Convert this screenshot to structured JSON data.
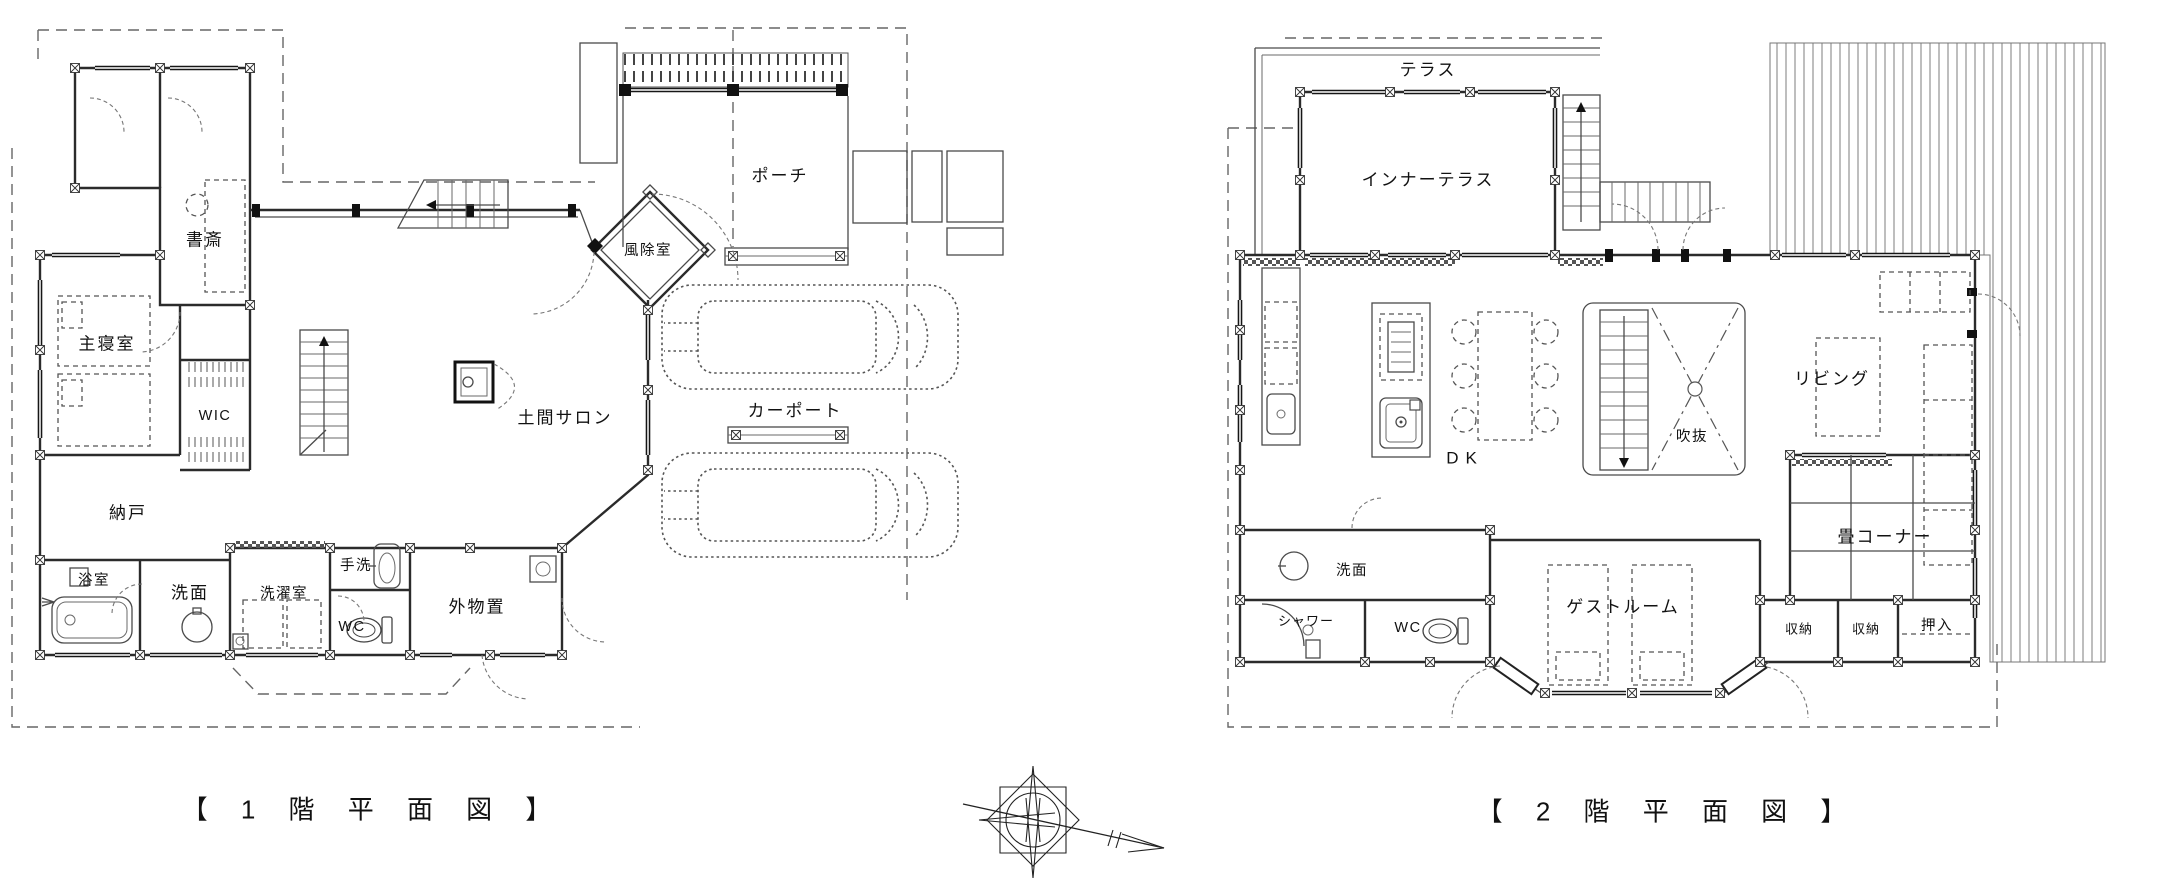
{
  "colors": {
    "ink": "#2b2b2b",
    "background": "#ffffff"
  },
  "icons": {
    "compass": "compass-rose-north-arrow",
    "cars": "car-outline",
    "stairs": "stair-flight"
  },
  "floor1": {
    "caption": "【 1 階 平 面 図 】",
    "rooms": {
      "study": "書斎",
      "master_bedroom": "主寝室",
      "wic": "WIC",
      "storeroom": "納戸",
      "bathroom": "浴室",
      "washroom": "洗面",
      "laundry": "洗濯室",
      "hand_basin": "手洗",
      "wc": "WC",
      "outdoor_storage": "外物置",
      "doma_salon": "土間サロン",
      "windbreak_room": "風除室",
      "porch": "ポーチ",
      "carport": "カーポート"
    }
  },
  "floor2": {
    "caption": "【 2 階 平 面 図 】",
    "rooms": {
      "terrace": "テラス",
      "inner_terrace": "インナーテラス",
      "dk": "DK",
      "void_atrium": "吹抜",
      "living": "リビング",
      "tatami_corner": "畳コーナー",
      "washroom": "洗面",
      "shower": "シャワー",
      "wc": "WC",
      "guest_room": "ゲストルーム",
      "closet1": "収納",
      "closet2": "収納",
      "futon_closet": "押入"
    }
  }
}
